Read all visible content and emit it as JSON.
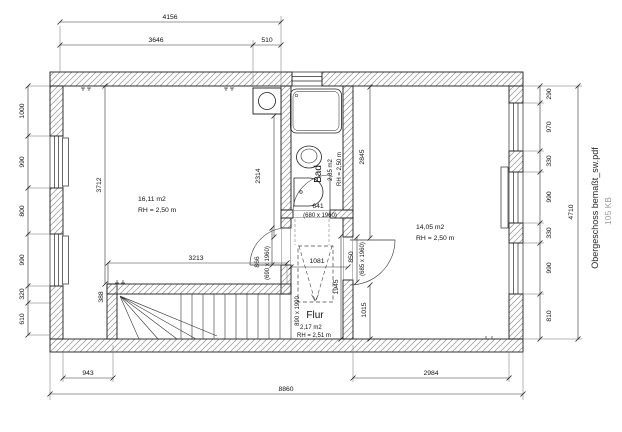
{
  "file": {
    "name": "Obergeschoss bemaßt_sw.pdf",
    "size": "105 KB"
  },
  "rooms": {
    "left": {
      "area": "16,11 m2",
      "height": "RH = 2,50 m"
    },
    "bad": {
      "name": "Bad",
      "area": "2,85 m2",
      "height": "RH = 2,50 m"
    },
    "flur": {
      "name": "Flur",
      "area": "2,17 m2",
      "height": "RH = 2,51 m"
    },
    "right": {
      "area": "14,05 m2",
      "height": "RH = 2,50 m"
    }
  },
  "dims": {
    "top_total": "4156",
    "top_left": "3646",
    "top_chimney": "510",
    "left_1": "1000",
    "left_2": "990",
    "left_3": "800",
    "left_4": "990",
    "left_5": "320",
    "left_6": "610",
    "right_1": "290",
    "right_2": "970",
    "right_3": "330",
    "right_4": "990",
    "right_5": "330",
    "right_6": "990",
    "right_7": "810",
    "right_total": "4710",
    "bottom_left": "943",
    "bottom_right": "2984",
    "bottom_total": "8860",
    "room_left_depth": "3712",
    "room_left_inner": "2314",
    "room_right_depth": "2845",
    "stair_length": "3213",
    "stair_offset": "388",
    "stair_opening": "890 x 1990",
    "flur_width": "1081",
    "flur_depth": "1945",
    "wall_segment": "1015",
    "door_bad": "641",
    "door_bad_size": "(680 x 1960)",
    "door_left": "866",
    "door_left_size": "(690 x 1960)",
    "door_right": "850",
    "door_right_size": "(685 x 1960)"
  }
}
